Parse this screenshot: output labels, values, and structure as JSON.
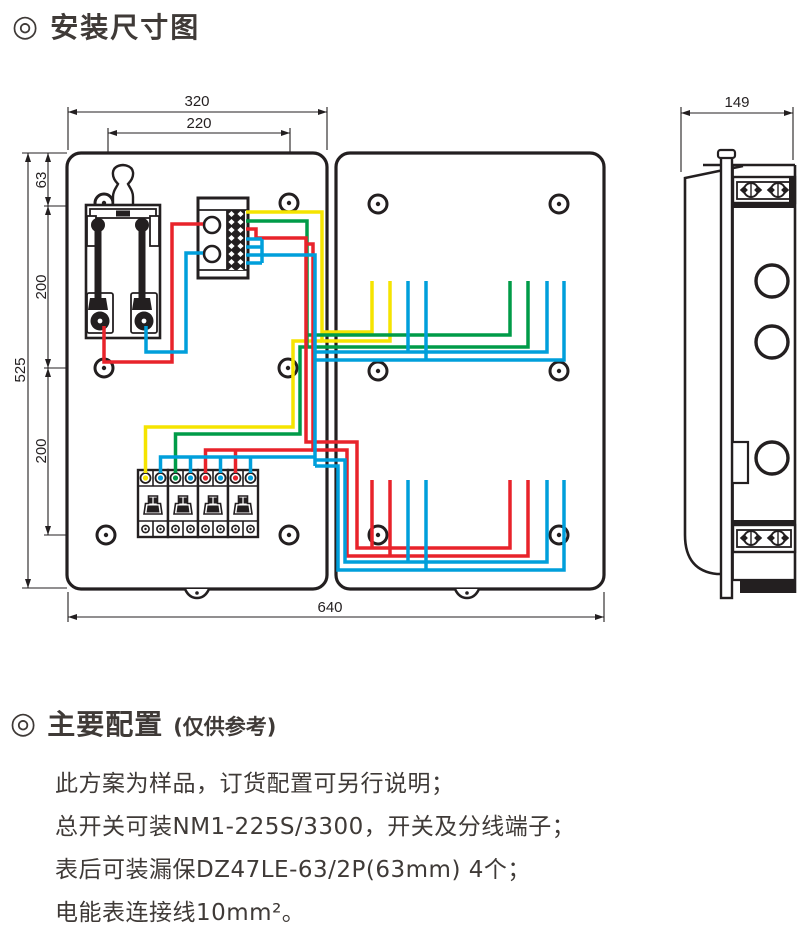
{
  "sections": {
    "bullet": "◎",
    "title1": "安装尺寸图",
    "title2": "主要配置",
    "title2_suffix": "(仅供参考)",
    "notes": [
      "此方案为样品，订货配置可另行说明；",
      "总开关可装NM1-225S/3300，开关及分线端子；",
      "表后可装漏保DZ47LE-63/2P(63mm) 4个；",
      "电能表连接线10mm²。"
    ]
  },
  "diagram": {
    "dims": {
      "top_outer": "320",
      "top_inner": "220",
      "left_total": "525",
      "chain": [
        "63",
        "200",
        "200"
      ],
      "bottom": "640",
      "side_width": "149"
    },
    "colors": {
      "line": "#231f20",
      "wire_yellow": "#f5e400",
      "wire_green": "#009b48",
      "wire_red": "#e8232b",
      "wire_blue": "#009fdb"
    }
  }
}
